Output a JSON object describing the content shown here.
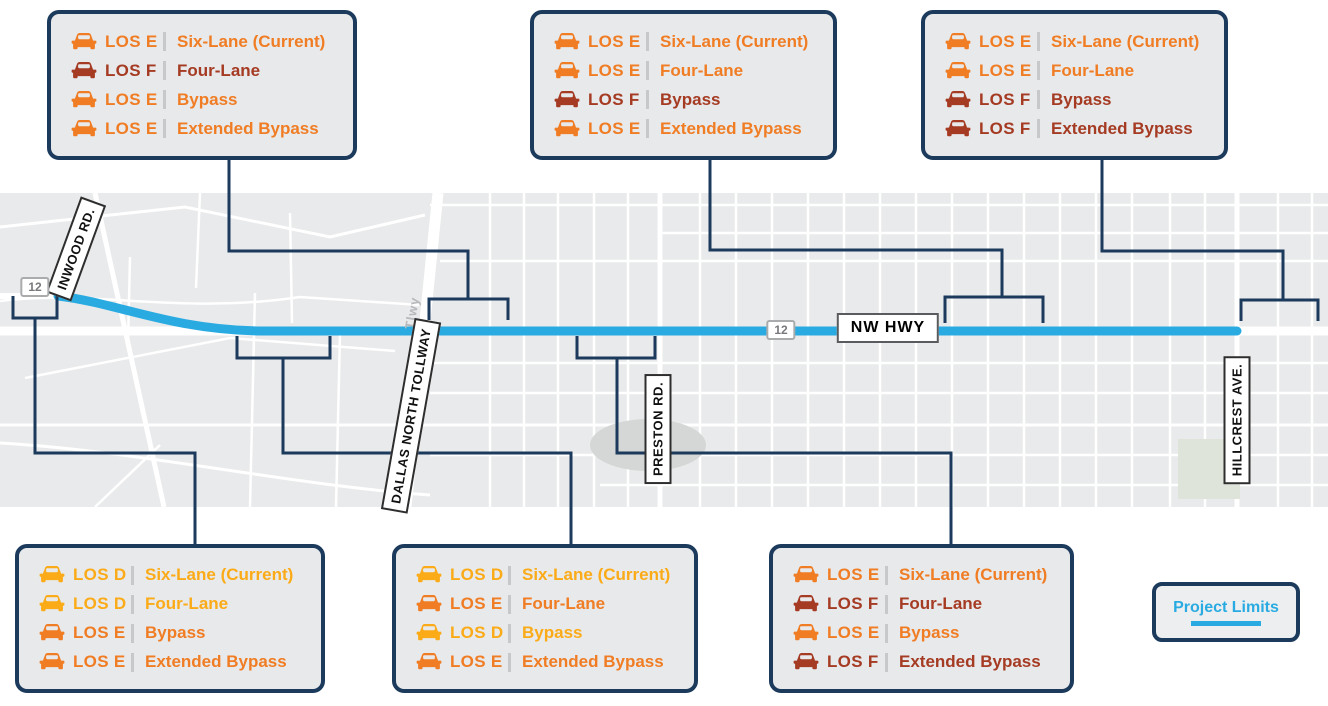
{
  "colors": {
    "los_d": "#fbab18",
    "los_e": "#f07d24",
    "los_f": "#a53b23",
    "navy": "#1b3a5c",
    "project_blue": "#29abe2"
  },
  "map": {
    "road_labels": {
      "inwood": "INWOOD RD.",
      "tollway": "DALLAS NORTH TOLLWAY",
      "preston": "PRESTON RD.",
      "hillcrest": "HILLCREST AVE.",
      "nw_hwy": "NW HWY",
      "tollway_small": "Tlwy"
    },
    "shields": [
      "12",
      "12"
    ]
  },
  "legend": {
    "label": "Project Limits"
  },
  "callouts": [
    {
      "id": "top-left",
      "rows": [
        {
          "los": "LOS E",
          "grade": "e",
          "scenario": "Six-Lane (Current)"
        },
        {
          "los": "LOS F",
          "grade": "f",
          "scenario": "Four-Lane"
        },
        {
          "los": "LOS E",
          "grade": "e",
          "scenario": "Bypass"
        },
        {
          "los": "LOS E",
          "grade": "e",
          "scenario": "Extended Bypass"
        }
      ]
    },
    {
      "id": "top-center",
      "rows": [
        {
          "los": "LOS E",
          "grade": "e",
          "scenario": "Six-Lane (Current)"
        },
        {
          "los": "LOS E",
          "grade": "e",
          "scenario": "Four-Lane"
        },
        {
          "los": "LOS F",
          "grade": "f",
          "scenario": "Bypass"
        },
        {
          "los": "LOS E",
          "grade": "e",
          "scenario": "Extended Bypass"
        }
      ]
    },
    {
      "id": "top-right",
      "rows": [
        {
          "los": "LOS E",
          "grade": "e",
          "scenario": "Six-Lane (Current)"
        },
        {
          "los": "LOS E",
          "grade": "e",
          "scenario": "Four-Lane"
        },
        {
          "los": "LOS F",
          "grade": "f",
          "scenario": "Bypass"
        },
        {
          "los": "LOS F",
          "grade": "f",
          "scenario": "Extended Bypass"
        }
      ]
    },
    {
      "id": "bottom-left",
      "rows": [
        {
          "los": "LOS D",
          "grade": "d",
          "scenario": "Six-Lane (Current)"
        },
        {
          "los": "LOS D",
          "grade": "d",
          "scenario": "Four-Lane"
        },
        {
          "los": "LOS E",
          "grade": "e",
          "scenario": "Bypass"
        },
        {
          "los": "LOS E",
          "grade": "e",
          "scenario": "Extended Bypass"
        }
      ]
    },
    {
      "id": "bottom-center",
      "rows": [
        {
          "los": "LOS D",
          "grade": "d",
          "scenario": "Six-Lane (Current)"
        },
        {
          "los": "LOS E",
          "grade": "e",
          "scenario": "Four-Lane"
        },
        {
          "los": "LOS D",
          "grade": "d",
          "scenario": "Bypass"
        },
        {
          "los": "LOS E",
          "grade": "e",
          "scenario": "Extended Bypass"
        }
      ]
    },
    {
      "id": "bottom-right",
      "rows": [
        {
          "los": "LOS E",
          "grade": "e",
          "scenario": "Six-Lane (Current)"
        },
        {
          "los": "LOS F",
          "grade": "f",
          "scenario": "Four-Lane"
        },
        {
          "los": "LOS E",
          "grade": "e",
          "scenario": "Bypass"
        },
        {
          "los": "LOS F",
          "grade": "f",
          "scenario": "Extended Bypass"
        }
      ]
    }
  ]
}
